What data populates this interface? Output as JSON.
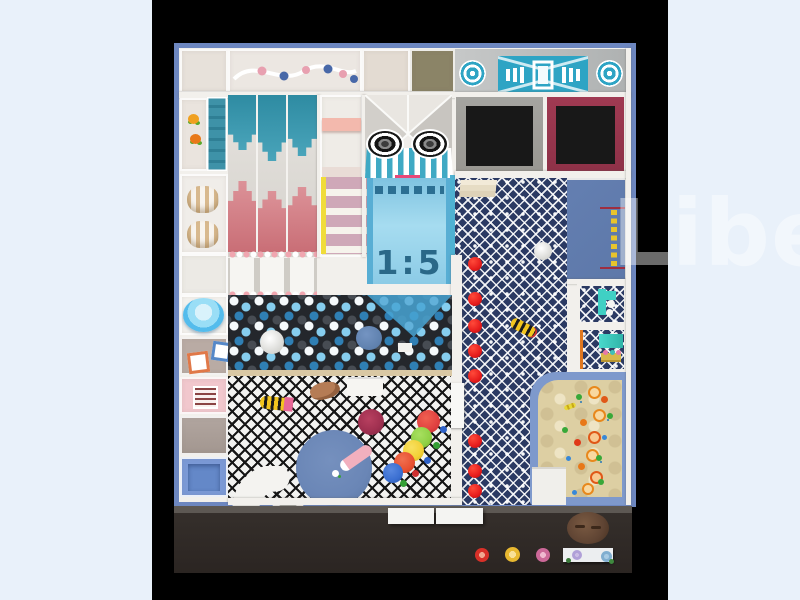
{
  "scene": {
    "description": "Top view 3D render of an indoor kids playground floor plan",
    "watermark_text": "Libe",
    "slope_sign": "1:5"
  },
  "palette": {
    "bg": "#e9f1fa",
    "letterbox": "#000000",
    "frame": "#6d87c0",
    "wall": "#f2f0ec",
    "floor_gray": "#bcbfbf",
    "olive": "#8b8467",
    "teal": "#3e9cb4",
    "stage_teal": "#2ea4c4",
    "pink_slide": "#d5838a",
    "navy": "#2b3a63",
    "tramp_gray": "#999792",
    "tramp_maroon": "#8e3148",
    "slope_blue": "#8ecbe6",
    "slope_text": "#2a6888",
    "red_dot": "#e61c1c",
    "sand": "#ddcfa3",
    "sand_border": "#7e99cc",
    "platform_blue": "#5d78a9",
    "rug_blue": "#6a86b6",
    "bottom_floor": "#352f2b",
    "brown": "#5f4433",
    "pink_cell": "#f1c7cd",
    "mat_blue": "#7b99d6",
    "bowl_blue": "#54bcec",
    "ladder_yellow": "#f0dc3a",
    "rung_pink": "#cfa8b8",
    "aqua": "#40d0c4"
  }
}
